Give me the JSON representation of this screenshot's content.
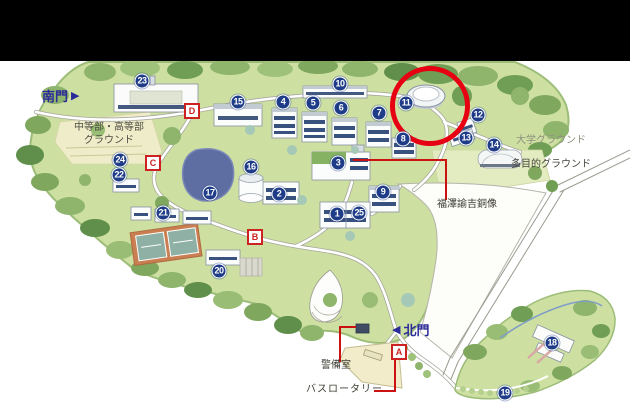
{
  "page": {
    "top_bar_color": "#000000",
    "background": "#ffffff"
  },
  "map": {
    "gates": {
      "south": {
        "label": "南門",
        "arrow": "▶"
      },
      "north": {
        "label": "北門",
        "arrow": "◀"
      }
    },
    "area_labels": {
      "junior_senior_ground": "中等部・高等部\nグラウンド",
      "university_ground": "大学グラウンド",
      "multipurpose_ground": "多目的グラウンド"
    },
    "callouts": {
      "fukuzawa_statue": "福澤諭吉銅像",
      "guard_room": "警備室",
      "bus_rotary": "バスロータリー"
    },
    "building_markers": [
      {
        "num": "1",
        "x": 337,
        "y": 214
      },
      {
        "num": "2",
        "x": 279,
        "y": 194
      },
      {
        "num": "3",
        "x": 338,
        "y": 163
      },
      {
        "num": "4",
        "x": 283,
        "y": 102
      },
      {
        "num": "5",
        "x": 313,
        "y": 103
      },
      {
        "num": "6",
        "x": 341,
        "y": 108
      },
      {
        "num": "7",
        "x": 379,
        "y": 113
      },
      {
        "num": "8",
        "x": 403,
        "y": 139
      },
      {
        "num": "9",
        "x": 383,
        "y": 192
      },
      {
        "num": "10",
        "x": 340,
        "y": 84
      },
      {
        "num": "11",
        "x": 406,
        "y": 103
      },
      {
        "num": "12",
        "x": 478,
        "y": 115
      },
      {
        "num": "13",
        "x": 466,
        "y": 138
      },
      {
        "num": "14",
        "x": 494,
        "y": 145
      },
      {
        "num": "15",
        "x": 238,
        "y": 102
      },
      {
        "num": "16",
        "x": 251,
        "y": 167
      },
      {
        "num": "17",
        "x": 210,
        "y": 193
      },
      {
        "num": "18",
        "x": 552,
        "y": 343
      },
      {
        "num": "19",
        "x": 505,
        "y": 393
      },
      {
        "num": "20",
        "x": 219,
        "y": 271
      },
      {
        "num": "21",
        "x": 163,
        "y": 213
      },
      {
        "num": "22",
        "x": 119,
        "y": 175
      },
      {
        "num": "23",
        "x": 142,
        "y": 81
      },
      {
        "num": "24",
        "x": 120,
        "y": 160
      },
      {
        "num": "25",
        "x": 359,
        "y": 213
      }
    ],
    "letter_markers": [
      {
        "letter": "A",
        "x": 399,
        "y": 352
      },
      {
        "letter": "B",
        "x": 255,
        "y": 237
      },
      {
        "letter": "C",
        "x": 153,
        "y": 163
      },
      {
        "letter": "D",
        "x": 192,
        "y": 111
      }
    ],
    "highlight_circle": {
      "cx": 425,
      "cy": 101,
      "r": 35,
      "color": "#e60012"
    },
    "colors": {
      "marker_bg": "#1e3c87",
      "marker_text": "#ffffff",
      "letter_marker": "#cc2222",
      "gate_text": "#2a2a99",
      "campus_green": "#cde0a2",
      "pond_blue": "#5e6ea3"
    }
  }
}
